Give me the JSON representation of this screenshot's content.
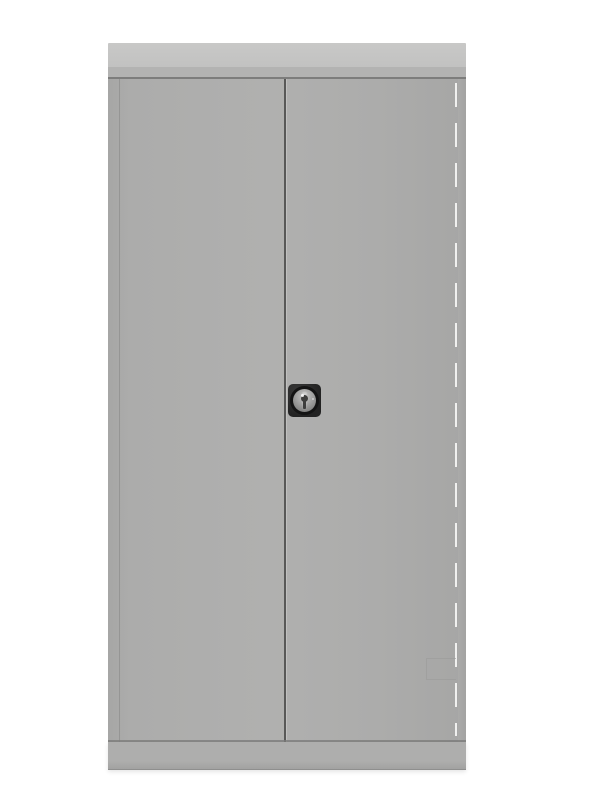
{
  "scene": {
    "title": "Grey steel double-door storage cupboard",
    "description": "Product photo of a tall grey two-door steel storage cupboard with a flat top cap, a black round cam lock with keyhole at the centre of the doors, a plinth base, photographed front-on against a plain white background",
    "door_count": 2,
    "lock": {
      "type": "round cam lock with keyhole",
      "escutcheon": "black rounded-square plate"
    }
  },
  "colors": {
    "background": "#ffffff",
    "cap_light": "#c8c8c7",
    "cap": "#c2c2c1",
    "cap_lip": "#b3b3b2",
    "door_face": "#acacab",
    "door_face_light": "#b0b0af",
    "door_edge_dark": "#a6a6a5",
    "door_top_line": "#7d7d7c",
    "door_fold_line": "#90908f",
    "door_gap": "#585857",
    "gap_highlight": "#c0c0bf",
    "edge_highlight": "#f0f0ef",
    "side_panel": "#a3a3a2",
    "side_panel_light": "#aaaaa9",
    "recess_line": "#9c9c9b",
    "plinth": "#aeaead",
    "plinth_dark": "#a2a2a1",
    "bottom_line": "#8f8f8e",
    "lock_plate": "#222222",
    "lock_ring": "#141414",
    "lock_face_light": "#c6c6c5",
    "lock_face": "#a0a09f",
    "lock_face_dark": "#6f6f6e",
    "keyhole": "#3e3e3d"
  }
}
